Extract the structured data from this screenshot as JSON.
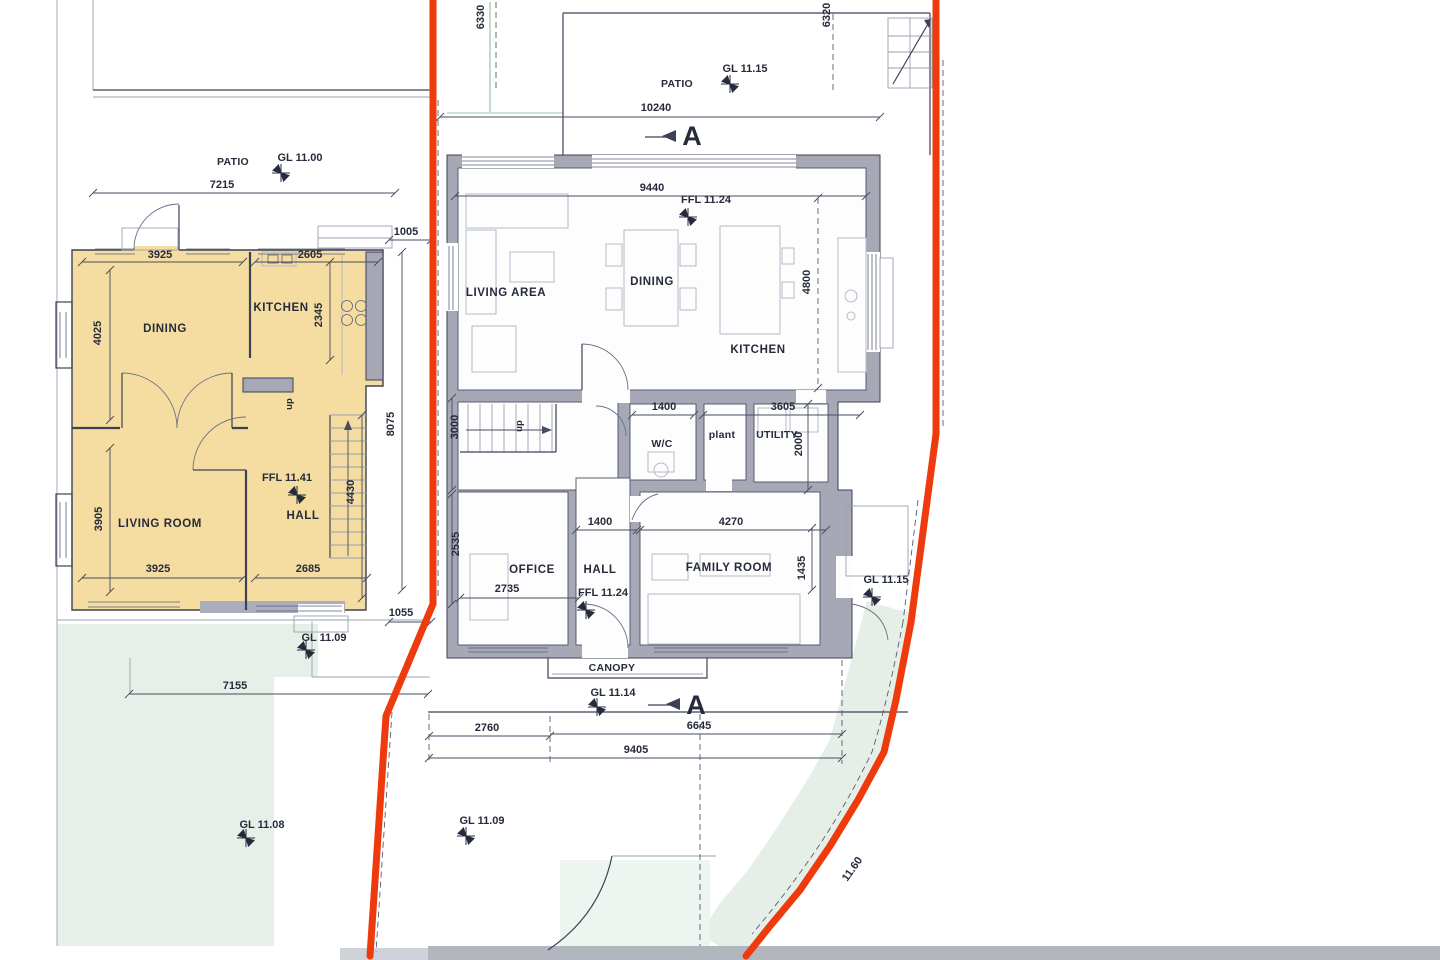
{
  "plan": {
    "left": {
      "patio": "PATIO",
      "gl_top": "GL 11.00",
      "d7215": "7215",
      "d1005": "1005",
      "d3925a": "3925",
      "d2605": "2605",
      "d4025": "4025",
      "d2345": "2345",
      "dining": "DINING",
      "kitchen": "KITCHEN",
      "up": "up",
      "living": "LIVING ROOM",
      "hall": "HALL",
      "ffl": "FFL 11.41",
      "d3905": "3905",
      "d4430": "4430",
      "d8075": "8075",
      "d3925b": "3925",
      "d2685": "2685",
      "d1055": "1055",
      "gl_bottom": "GL 11.09",
      "d7155": "7155"
    },
    "right": {
      "d6330": "6330",
      "d6320": "6320",
      "patio": "PATIO",
      "gl_patio": "GL 11.15",
      "d10240": "10240",
      "section_a": "A",
      "d9440": "9440",
      "ffl_top": "FFL 11.24",
      "living_area": "LIVING AREA",
      "dining": "DINING",
      "kitchen": "KITCHEN",
      "d4800": "4800",
      "d1400a": "1400",
      "d3605": "3605",
      "wc": "W/C",
      "plant": "plant",
      "utility": "UTILITY",
      "d3000": "3000",
      "d2000": "2000",
      "up": "up",
      "d1400b": "1400",
      "d4270": "4270",
      "d2535": "2535",
      "d2735": "2735",
      "office": "OFFICE",
      "hall": "HALL",
      "ffl_bottom": "FFL 11.24",
      "family": "FAMILY ROOM",
      "d1435": "1435",
      "gl_right": "GL 11.15",
      "canopy": "CANOPY",
      "gl_front": "GL 11.14",
      "section_a2": "A",
      "d2760": "2760",
      "d6645": "6645",
      "d9405": "9405"
    },
    "site": {
      "gl_garden_left": "GL 11.08",
      "gl_garden_mid": "GL 11.09",
      "boundary_level": "11.60"
    },
    "colors": {
      "highlight": "#f5dca0",
      "boundary_red": "#ee3a0c",
      "wall_gray": "#a6a8b6",
      "tint_green": "#e7f0e8",
      "line": "#3c4156"
    }
  }
}
